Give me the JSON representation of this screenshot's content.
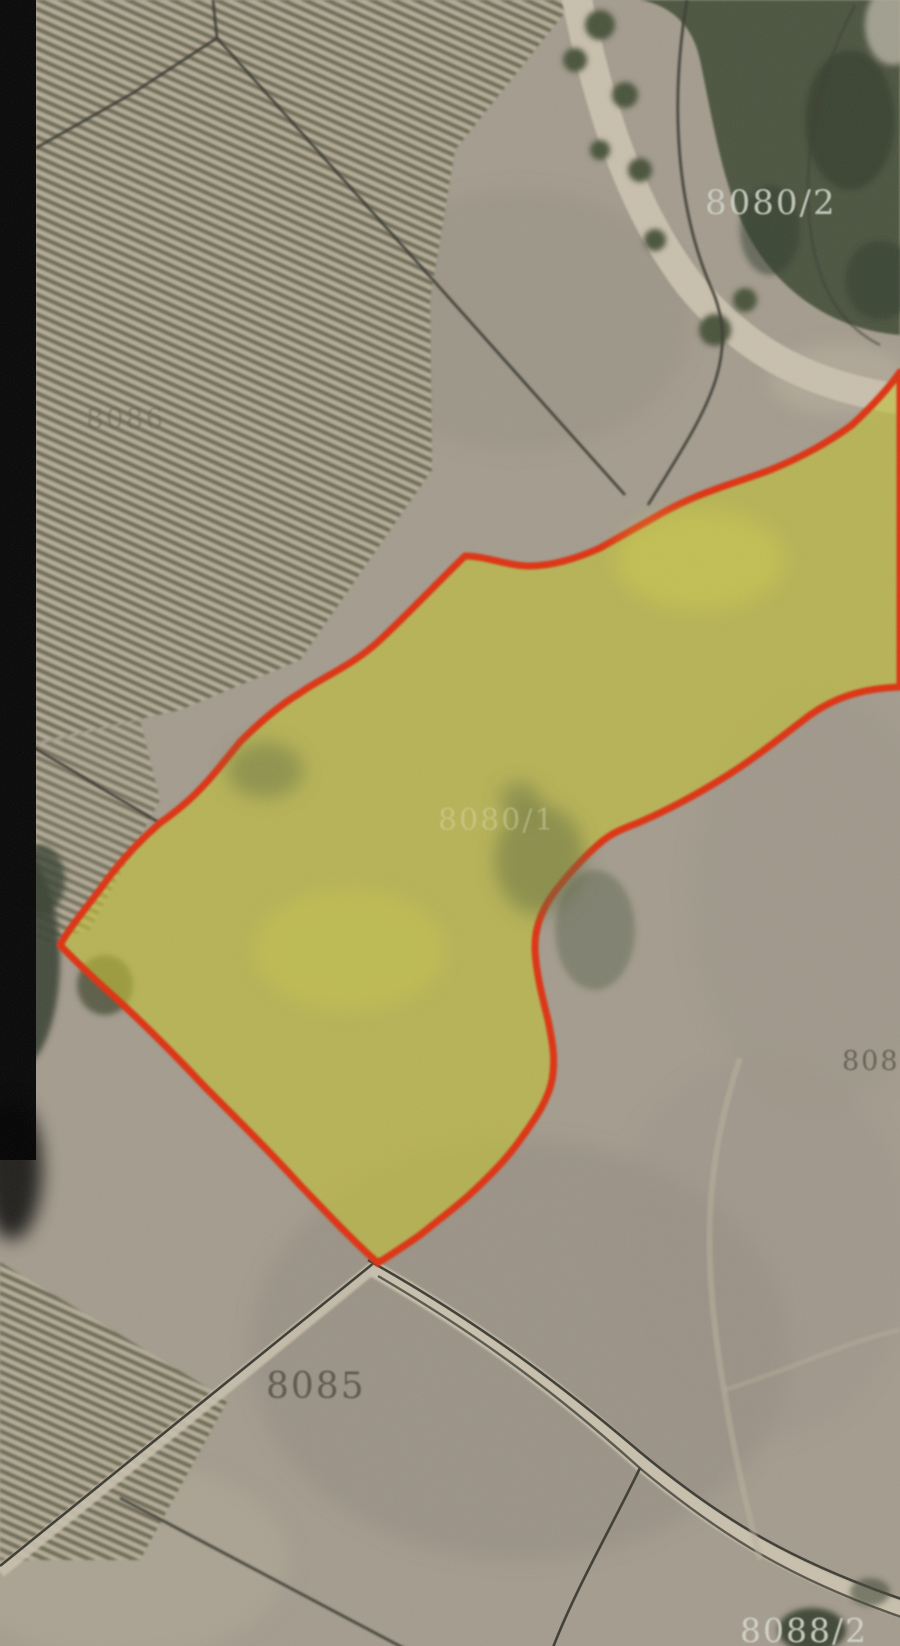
{
  "map": {
    "highlighted_parcel": {
      "label": "8080/1",
      "fill": "#c3c233",
      "fill_opacity": "0.62",
      "stroke": "#de3110",
      "stroke_width": "7"
    },
    "parcel_labels": [
      {
        "text": "8080/2",
        "color": "#ccd0c4",
        "opacity": "0.92"
      },
      {
        "text": "8086",
        "color": "#5c5f4e",
        "opacity": "0.40"
      },
      {
        "text": "8080/1",
        "color": "#d9d9ae",
        "opacity": "0.45"
      },
      {
        "text": "8085",
        "color": "#4f4a3d",
        "opacity": "0.80"
      },
      {
        "text": "808",
        "color": "#4f4a3d",
        "opacity": "0.70"
      },
      {
        "text": "8088/2",
        "color": "#d4d6cc",
        "opacity": "0.92"
      }
    ],
    "terrain_colors": {
      "base": "#a49c8e",
      "vineyard_stripe": "#6e6c55",
      "vineyard_light": "#b4ab97",
      "forest": "#46513b",
      "road": "#c9c0ad",
      "boundary_line": "#3c3b33",
      "edge_bar": "#060606"
    }
  }
}
